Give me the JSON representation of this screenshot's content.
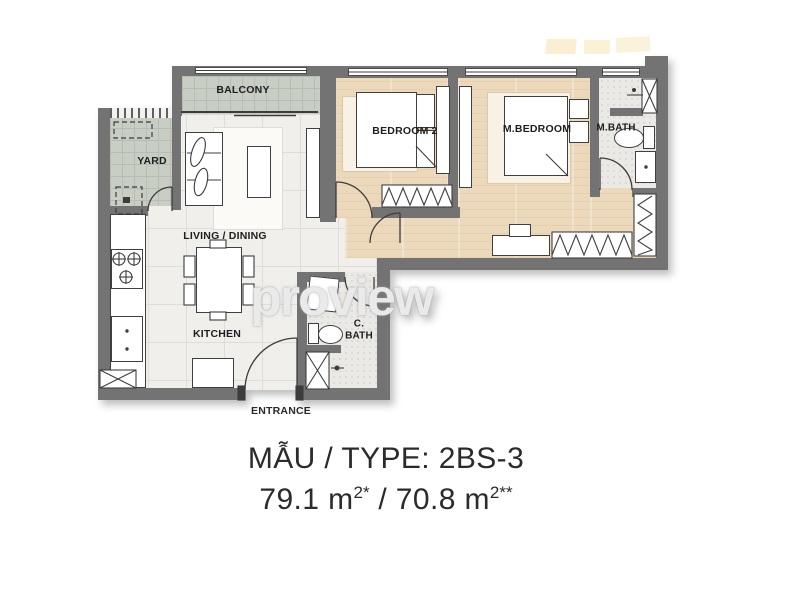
{
  "watermark": {
    "text": "proview"
  },
  "caption": {
    "line1": "MẪU / TYPE: 2BS-3",
    "area_prefix": "79.1 m",
    "area_sup1": "2*",
    "area_separator": " / 70.8 m",
    "area_sup2": "2**"
  },
  "rooms": {
    "balcony": "BALCONY",
    "yard": "YARD",
    "living_dining": "LIVING / DINING",
    "kitchen": "KITCHEN",
    "entrance": "ENTRANCE",
    "bedroom2": "BEDROOM 2",
    "master_bedroom": "M.BEDROOM",
    "master_bath": "M.BATH",
    "common_bath_line1": "C.",
    "common_bath_line2": "BATH"
  },
  "colors": {
    "wall": "#737373",
    "wood_floor": "#ecd9bb",
    "tile_floor": "#f0efec",
    "balcony_yard_floor": "#c9cec5",
    "bath_floor": "#ebe9e6",
    "caption_text": "#2b2b2b",
    "watermark_gray": "#d6d6d6",
    "stamp_yellow": "#f6dfa6"
  }
}
